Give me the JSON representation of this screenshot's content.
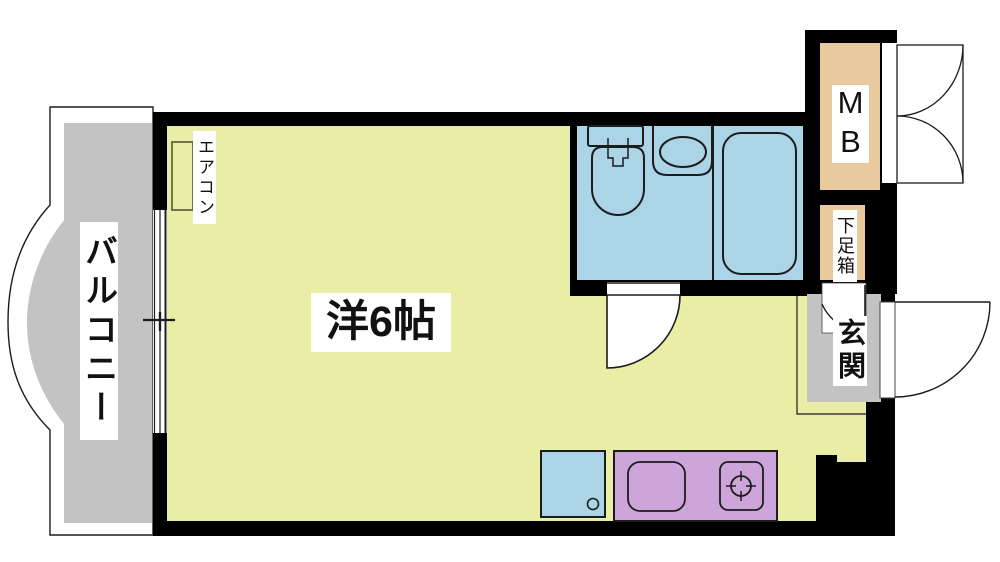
{
  "title": "apartment-floor-plan",
  "labels": {
    "balcony": "バルコニー",
    "room": "洋6帖",
    "air_conditioner": "エアコン",
    "meter_box": "MB",
    "shoe_box": "下足箱",
    "entrance": "玄関"
  },
  "colors": {
    "background": "#ffffff",
    "wall": "#000000",
    "room-floor": "#e9eda6",
    "wet-area": "#abd4e6",
    "balcony-floor": "#c3c3c3",
    "entrance-floor": "#c3c3c3",
    "meter-box": "#e9ca9e",
    "shoe-box": "#e9ca9e",
    "kitchen-counter": "#cda5da",
    "line": "#1c1c1c"
  }
}
